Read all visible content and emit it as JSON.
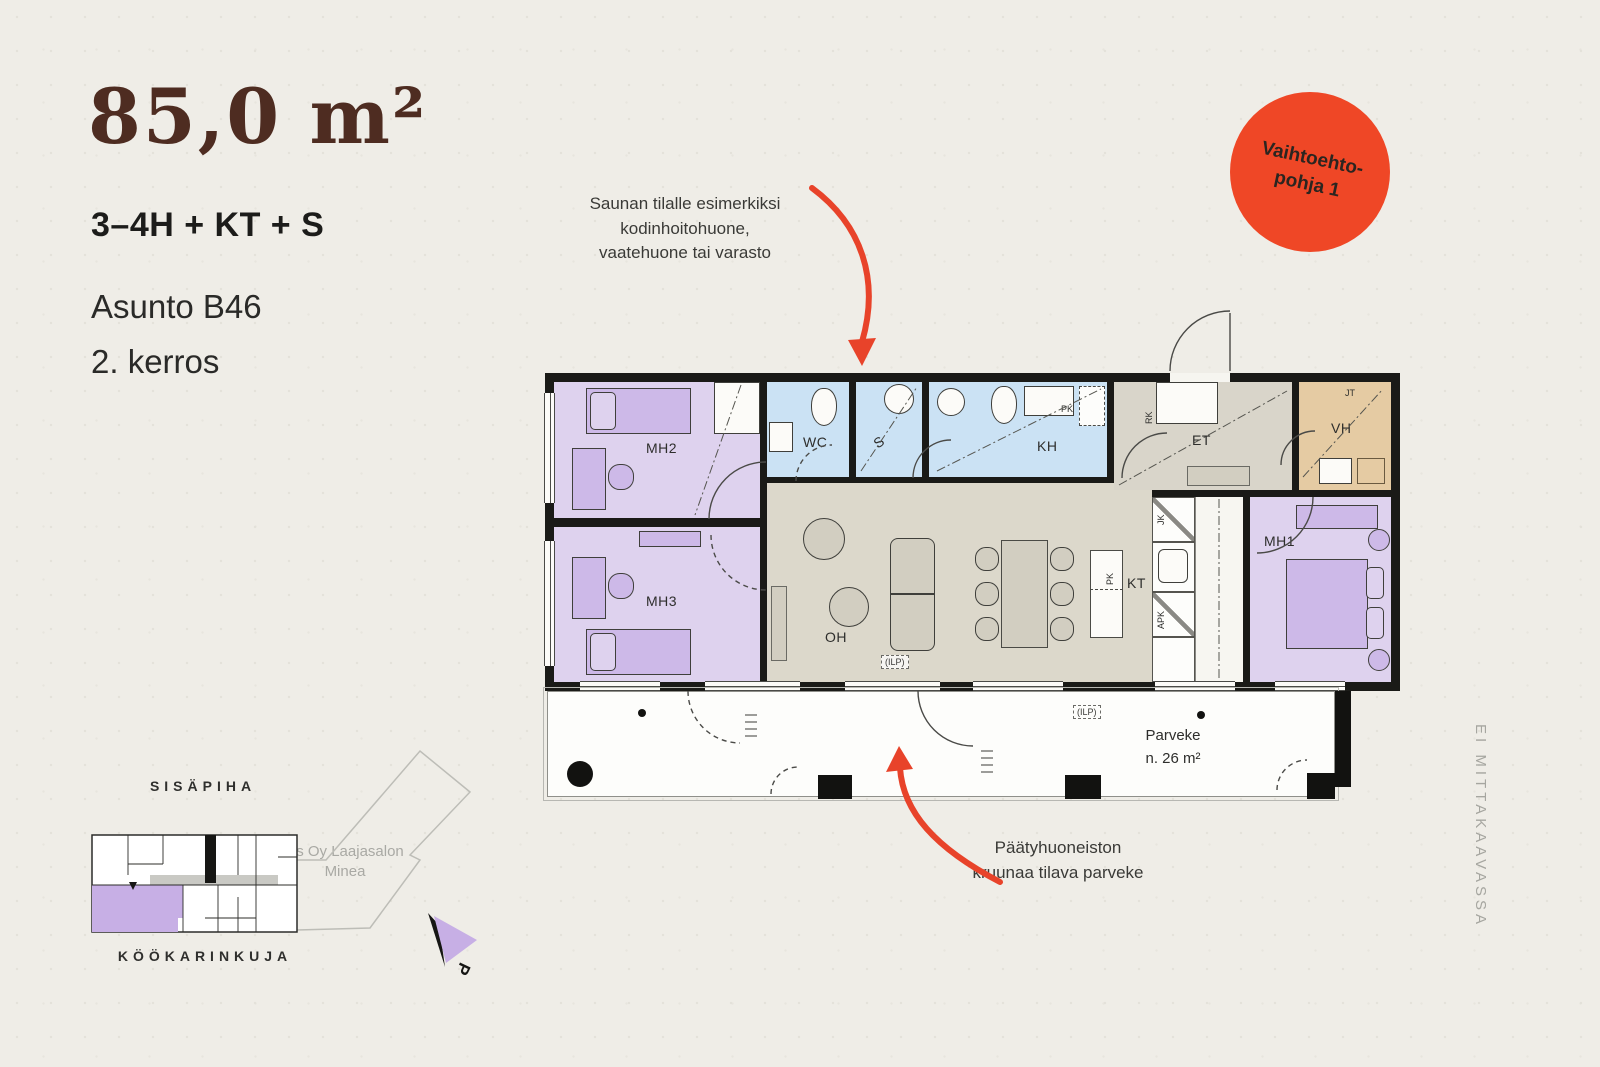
{
  "header": {
    "area": "85,0 m²",
    "type": "3–4H + KT + S",
    "apartment": "Asunto B46",
    "floor": "2. kerros"
  },
  "badge": {
    "line1": "Vaihtoehto-",
    "line2": "pohja 1",
    "bg_color": "#EF4726"
  },
  "annotations": {
    "sauna_note": "Saunan tilalle esimerkiksi kodinhoitohuone, vaatehuone tai varasto",
    "balcony_note": "Päätyhuoneiston kruunaa tilava parveke"
  },
  "plan": {
    "rooms": {
      "mh1": "MH1",
      "mh2": "MH2",
      "mh3": "MH3",
      "wc": "WC",
      "sauna": "S",
      "kh": "KH",
      "et": "ET",
      "vh": "VH",
      "oh": "OH",
      "kt": "KT"
    },
    "small_labels": {
      "jt": "JT",
      "rk": "RK",
      "jk": "JK",
      "apk": "APK",
      "pk_island": "PK",
      "pk_bath": "PK",
      "ilp": "(ILP)"
    },
    "balcony": {
      "name": "Parveke",
      "area": "n. 26 m²"
    },
    "colors": {
      "bedroom": "#DED2EE",
      "wet_room": "#CBE2F4",
      "living": "#DCD8CB",
      "hall": "#D9D5CA",
      "closet": "#E5CBA3",
      "wall": "#1A1A17",
      "accent": "#E8432A",
      "site_highlight": "#C7AFE5"
    }
  },
  "sitemap": {
    "courtyard": "SISÄPIHA",
    "street": "KÖÖKARINKUJA",
    "company": "As Oy Laajasalon Minea",
    "compass": "P"
  },
  "scale_note": "EI MITTAKAAVASSA"
}
